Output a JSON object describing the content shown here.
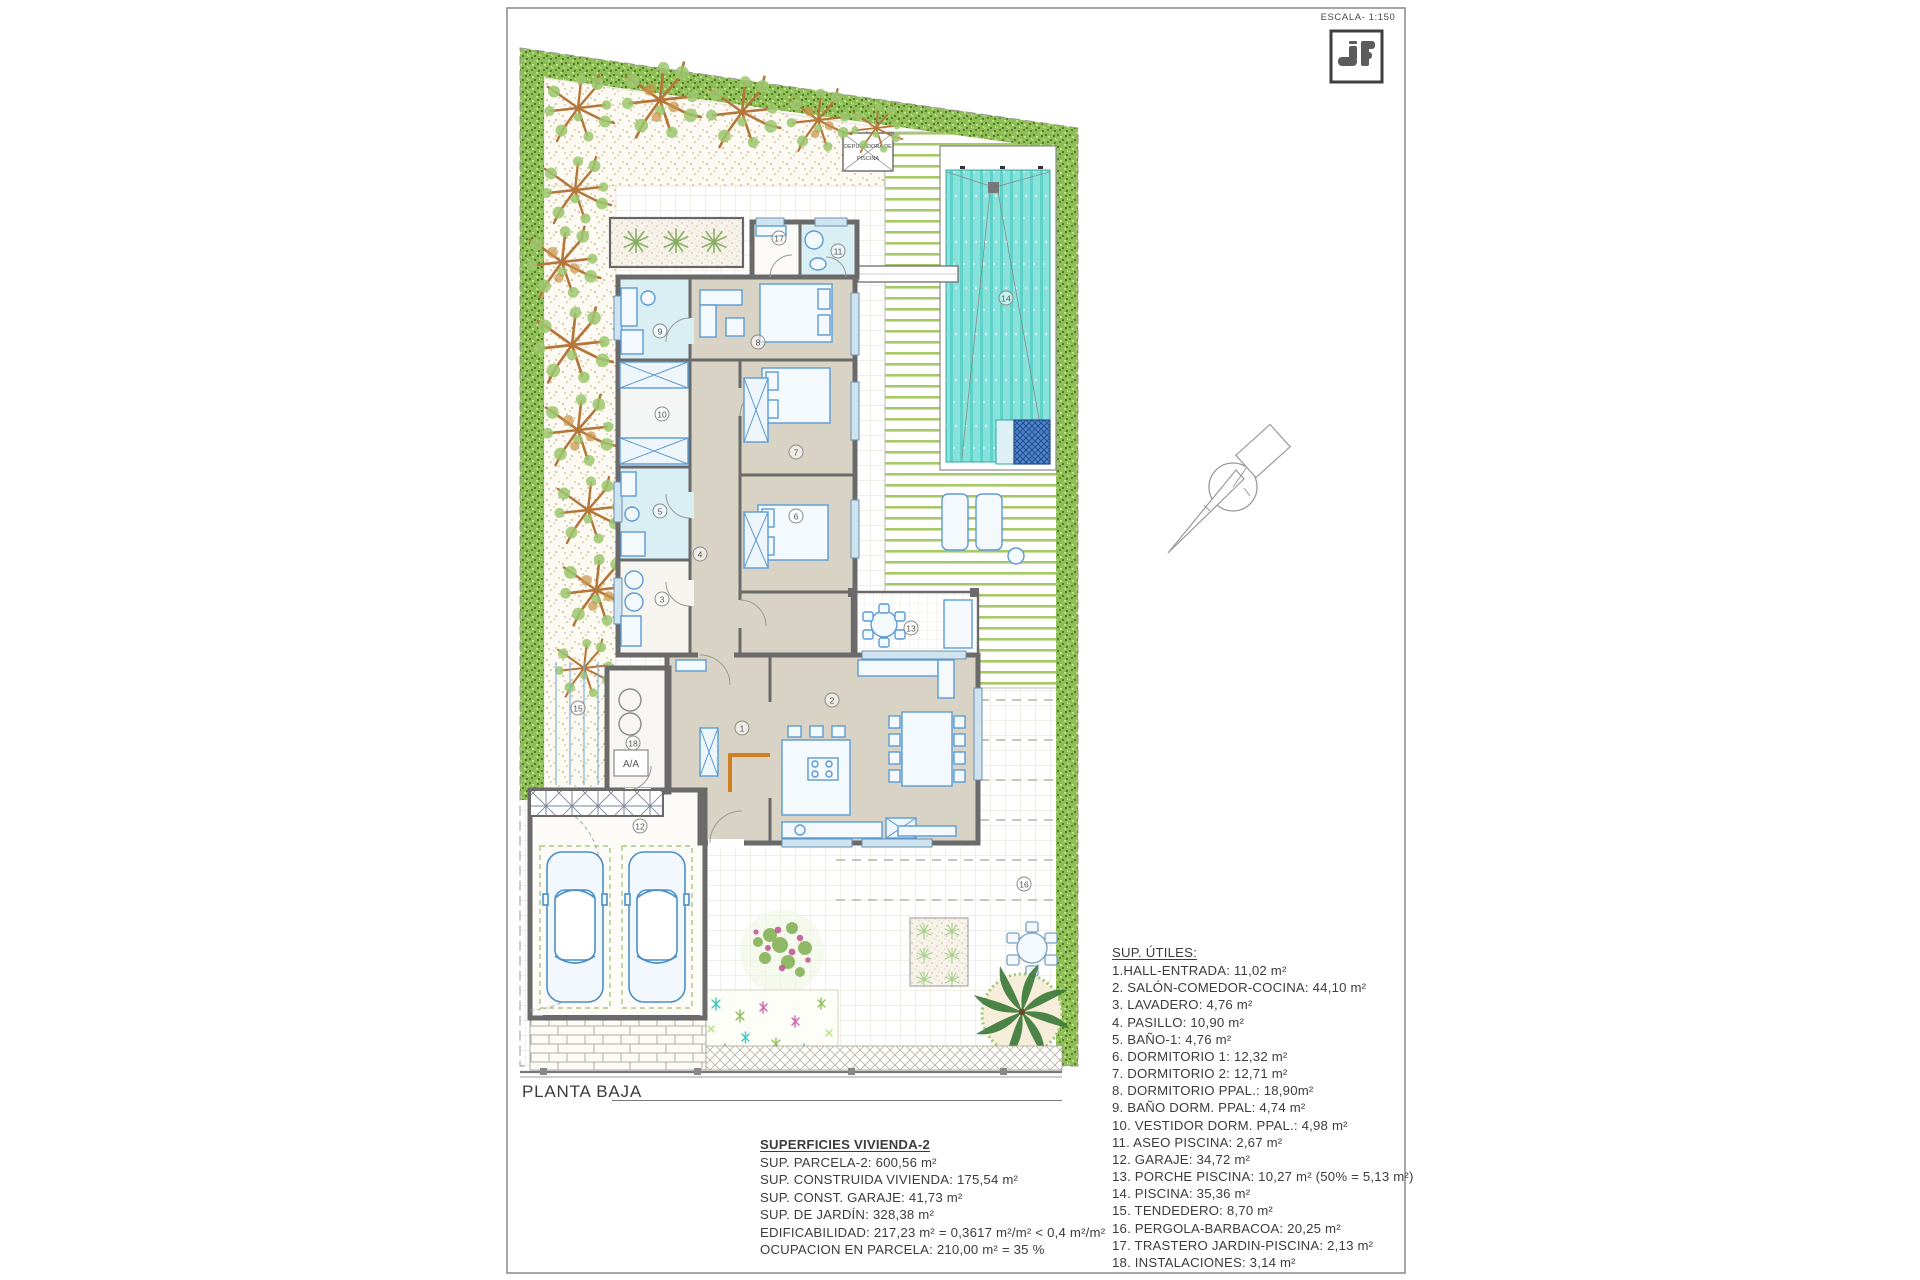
{
  "sheet": {
    "scale_label": "ESCALA- 1:150",
    "plan_title": "PLANTA BAJA"
  },
  "pool_equipment_box": {
    "line1": "DEPURADORA DE",
    "line2": "PISCINA"
  },
  "installations": {
    "aa_label": "A/A"
  },
  "legend": {
    "title": "SUP. ÚTILES:",
    "items": [
      "1.HALL-ENTRADA: 11,02 m²",
      "2. SALÓN-COMEDOR-COCINA: 44,10 m²",
      "3. LAVADERO: 4,76 m²",
      "4. PASILLO: 10,90 m²",
      "5. BAÑO-1: 4,76 m²",
      "6. DORMITORIO 1: 12,32 m²",
      "7. DORMITORIO 2: 12,71 m²",
      "8. DORMITORIO PPAL.: 18,90m²",
      "9. BAÑO DORM. PPAL: 4,74 m²",
      "10. VESTIDOR DORM. PPAL.: 4,98 m²",
      "11. ASEO PISCINA:  2,67 m²",
      "12. GARAJE: 34,72 m²",
      "13. PORCHE PISCINA: 10,27 m² (50% = 5,13 m²)",
      "14. PISCINA: 35,36 m²",
      "15. TENDEDERO: 8,70 m²",
      "16. PERGOLA-BARBACOA: 20,25 m²",
      "17. TRASTERO JARDIN-PISCINA: 2,13 m²",
      "18. INSTALACIONES: 3,14 m²"
    ]
  },
  "summary": {
    "title": "SUPERFICIES VIVIENDA-2",
    "lines": [
      "SUP. PARCELA-2: 600,56 m²",
      "SUP. CONSTRUIDA VIVIENDA: 175,54 m²",
      "SUP. CONST. GARAJE: 41,73 m²",
      "SUP. DE JARDÍN: 328,38 m²",
      "EDIFICABILIDAD: 217,23  m² = 0,3617 m²/m² < 0,4 m²/m²",
      "OCUPACION EN PARCELA: 210,00 m² = 35 %"
    ]
  },
  "room_markers": [
    {
      "n": "1",
      "x": 742,
      "y": 728
    },
    {
      "n": "2",
      "x": 832,
      "y": 700
    },
    {
      "n": "3",
      "x": 662,
      "y": 599
    },
    {
      "n": "4",
      "x": 700,
      "y": 554
    },
    {
      "n": "5",
      "x": 660,
      "y": 511
    },
    {
      "n": "6",
      "x": 796,
      "y": 516
    },
    {
      "n": "7",
      "x": 796,
      "y": 452
    },
    {
      "n": "8",
      "x": 758,
      "y": 342
    },
    {
      "n": "9",
      "x": 660,
      "y": 331
    },
    {
      "n": "10",
      "x": 662,
      "y": 414
    },
    {
      "n": "11",
      "x": 838,
      "y": 251
    },
    {
      "n": "12",
      "x": 640,
      "y": 826
    },
    {
      "n": "13",
      "x": 911,
      "y": 628
    },
    {
      "n": "14",
      "x": 1006,
      "y": 298
    },
    {
      "n": "15",
      "x": 578,
      "y": 708
    },
    {
      "n": "16",
      "x": 1024,
      "y": 884
    },
    {
      "n": "17",
      "x": 779,
      "y": 238
    },
    {
      "n": "18",
      "x": 633,
      "y": 743
    }
  ],
  "colors": {
    "wall": "#6a6a6a",
    "pool_water": "#86e2db",
    "hedge_green": "#8fbe57",
    "deck_stripe": "#a6c968",
    "furniture_blue": "#5b9bd5",
    "interior_beige": "#d8d3c4",
    "bath_cyan": "#d9eff3",
    "accent_door_orange": "#d08020",
    "logo_gray": "#5c5c5c"
  }
}
